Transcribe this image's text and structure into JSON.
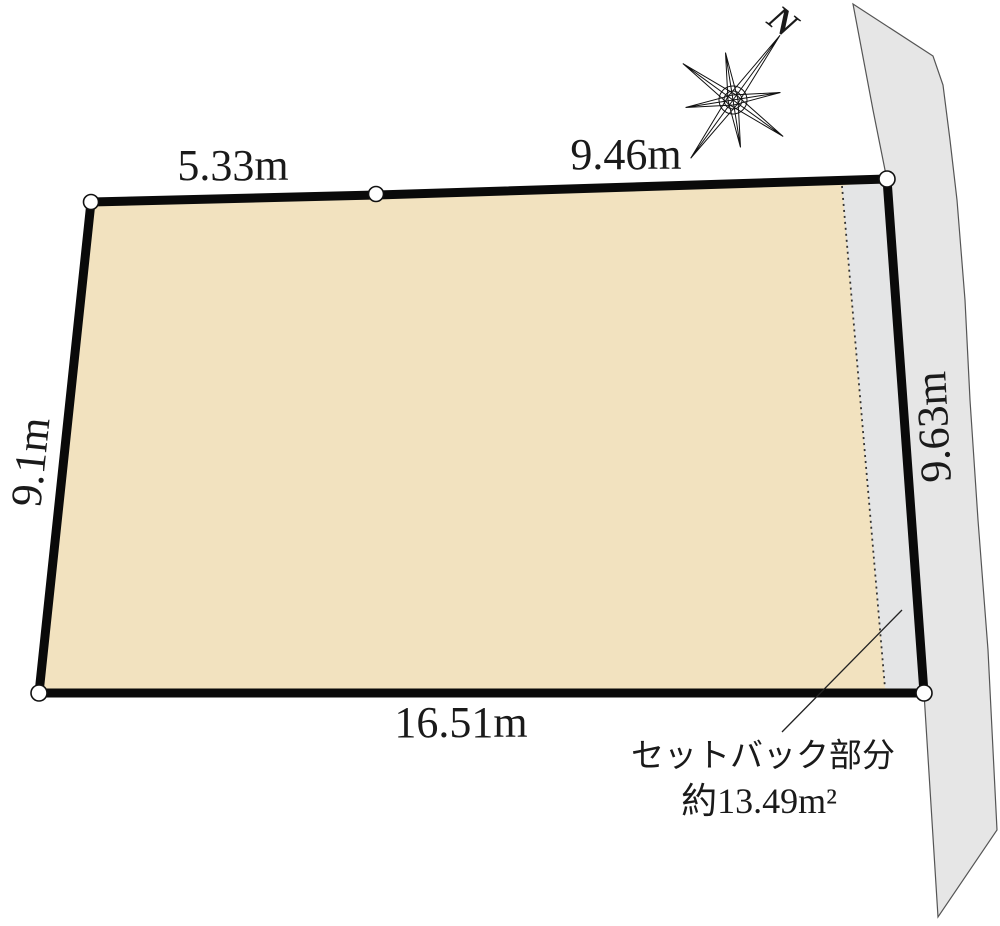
{
  "diagram": {
    "type": "land-plot-survey-drawing",
    "compass": {
      "north_label": "N"
    },
    "dimensions": {
      "top_left_edge": "5.33m",
      "top_right_edge": "9.46m",
      "left_edge": "9.1m",
      "right_edge": "9.63m",
      "bottom_edge": "16.51m"
    },
    "setback": {
      "label_line1": "セットバック部分",
      "label_line2": "約13.49m²"
    },
    "colors": {
      "plot_fill": "#f2e2bf",
      "road_fill": "#e6e6e6",
      "setback_fill": "#e4e5e6",
      "border": "#0a0a0a",
      "vertex_fill": "#ffffff"
    }
  }
}
